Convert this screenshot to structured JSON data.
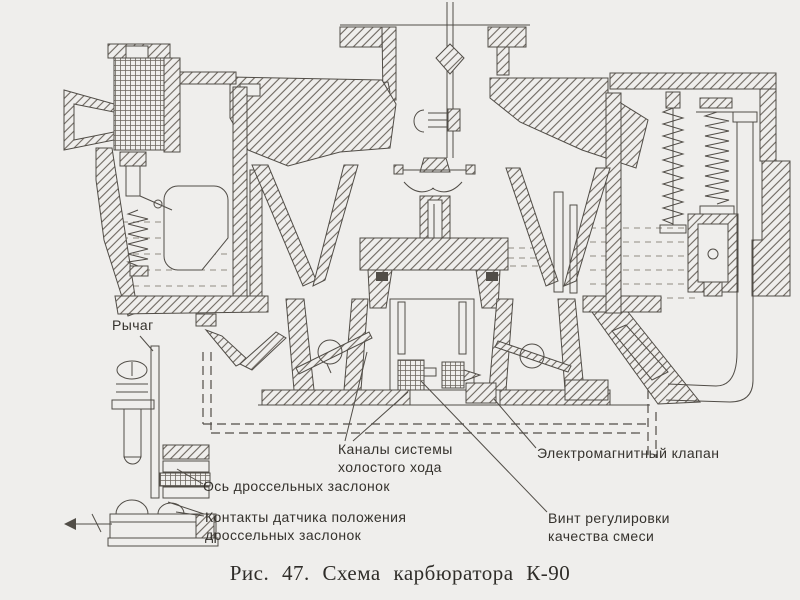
{
  "figure": {
    "caption": "Рис. 47. Схема карбюратора К-90",
    "kind": "Схема карбюратора в разрезе"
  },
  "labels": {
    "lever": "Рычаг",
    "throttle_axis": "Ось дроссельных заслонок",
    "sensor_contacts": "Контакты датчика положения\nдроссельных заслонок",
    "idle_channels": "Каналы системы\nхолостого хода",
    "solenoid_valve": "Электромагнитный клапан",
    "mixture_screw": "Винт регулировки\nкачества смеси"
  },
  "colors": {
    "background": "#efeeec",
    "ink": "#514d47",
    "label_ink": "#35322d"
  }
}
